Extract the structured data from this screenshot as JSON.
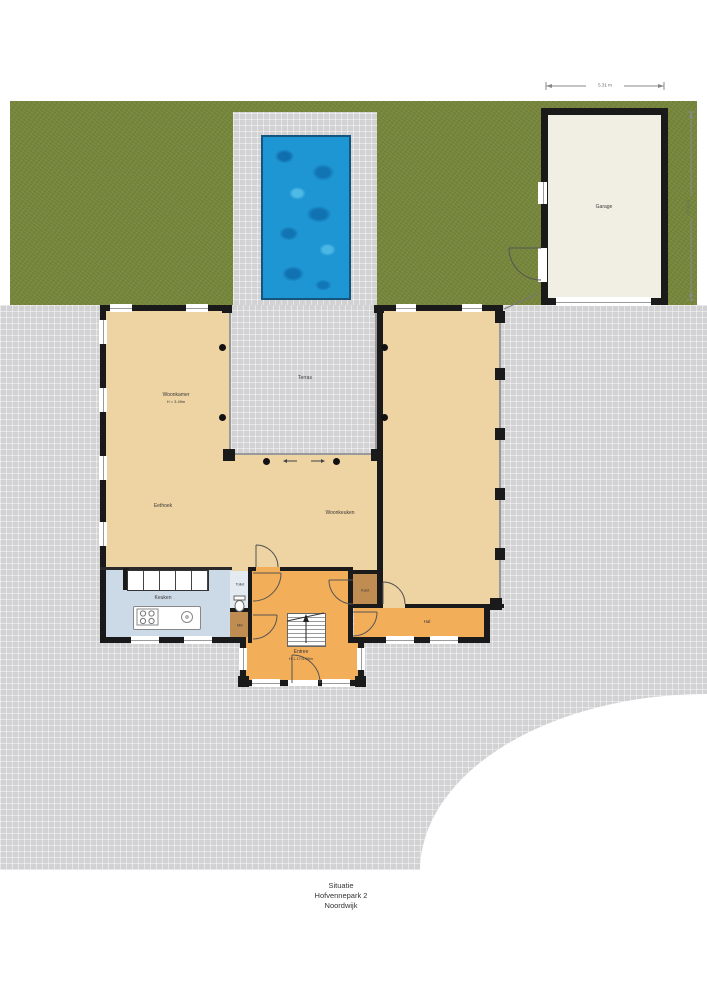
{
  "colors": {
    "wall": "#1a1a1a",
    "grass": "#77883d",
    "paving": "#d2d2d4",
    "water": "#1e96d3",
    "room-tan": "#eed3a3",
    "room-orange": "#f2ae58",
    "room-brown": "#bf8c52",
    "room-blue": "#ccd9e6",
    "room-toilet": "#e3eaf0",
    "garage-fill": "#f1efe4",
    "label": "#3a3a3a"
  },
  "rooms": {
    "woonkamer": {
      "label": "Woonkamer",
      "note": "H = 3.49m"
    },
    "terras": {
      "label": "Terras"
    },
    "eethoek": {
      "label": "Eethoek"
    },
    "woonkeuken": {
      "label": "Woonkeuken"
    },
    "keuken": {
      "label": "Keuken"
    },
    "toilet": {
      "label": "Toilet"
    },
    "mk": {
      "label": "MK"
    },
    "kast": {
      "label": "Kast"
    },
    "hal": {
      "label": "Hal"
    },
    "entree": {
      "label": "Entree",
      "note": "H 1.17/3.08m"
    },
    "garage": {
      "label": "Garage"
    }
  },
  "dimensions": {
    "garage_width": "5.31 m",
    "garage_depth": "8.77 m"
  },
  "caption": {
    "line1": "Situatie",
    "line2": "Hofvennepark 2",
    "line3": "Noordwijk"
  }
}
